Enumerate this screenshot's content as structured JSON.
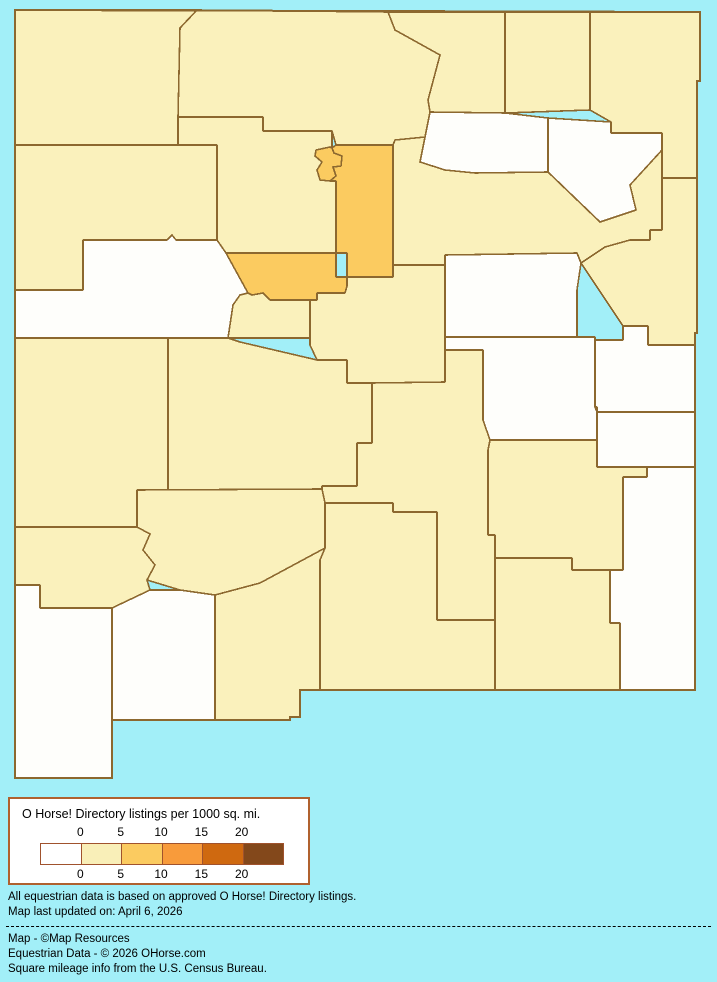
{
  "page": {
    "background": "#A2EFF8"
  },
  "map": {
    "border_color": "#8C682F",
    "outline_color": "#8C682F",
    "fills": {
      "zero": "#FEFEFB",
      "low": "#FAF1BC",
      "mid": "#FBCB60"
    },
    "outline_d": "M15,10 L700,12 L700,81 L697,81 L697,333 L695,333 L695,690 L300,690 L300,717 L290,717 L290,720 L112,720 L112,778 L15,778 Z",
    "regions": [
      {
        "name": "san-juan",
        "level": "low",
        "d": "M15,10 L197,10 L180,28 L178,117 L178,145 L15,145 Z"
      },
      {
        "name": "rio-arriba",
        "level": "low",
        "d": "M197,10 L388,12 L395,30 L440,55 L428,100 L430,112 L425,137 L395,140 L393,145 L336,145 L332,131 L263,131 L263,117 L178,117 L180,28 Z"
      },
      {
        "name": "taos",
        "level": "low",
        "d": "M388,12 L505,12 L505,113 L430,112 L428,100 L440,55 L395,30 Z"
      },
      {
        "name": "colfax",
        "level": "low",
        "d": "M505,12 L590,12 L590,110 L505,113 Z"
      },
      {
        "name": "union",
        "level": "low",
        "d": "M590,12 L700,12 L700,81 L697,81 L697,178 L662,178 L662,133 L611,133 L611,122 L590,110 Z"
      },
      {
        "name": "mckinley",
        "level": "low",
        "d": "M15,145 L217,145 L217,240 L176,240 L172,235 L167,240 L83,240 L83,290 L15,290 Z"
      },
      {
        "name": "sandoval",
        "level": "low",
        "d": "M178,117 L263,117 L263,131 L332,131 L332,148 L330,147 L316,150 L315,156 L322,162 L317,170 L320,180 L330,181 L336,181 L336,253 L226,253 L217,240 L217,145 L178,145 Z"
      },
      {
        "name": "los-alamos",
        "level": "mid",
        "d": "M316,150 L330,147 L332,148 L334,153 L342,156 L341,166 L333,167 L336,176 L330,181 L320,180 L317,170 L322,162 L315,156 Z"
      },
      {
        "name": "santa-fe",
        "level": "mid",
        "d": "M336,145 L393,145 L393,277 L347,277 L347,253 L336,253 L336,181 L330,181 L336,176 L333,167 L341,166 L342,156 L334,153 L332,148 Z"
      },
      {
        "name": "mora",
        "level": "zero",
        "d": "M430,112 L505,113 L548,118 L548,172 L475,173 L445,170 L420,162 L425,137 Z"
      },
      {
        "name": "harding",
        "level": "zero",
        "d": "M548,118 L611,122 L611,133 L662,133 L662,150 L630,185 L636,210 L600,222 L548,172 Z"
      },
      {
        "name": "san-miguel",
        "level": "low",
        "d": "M393,145 L395,140 L425,137 L420,162 L445,170 L475,173 L548,172 L600,222 L636,210 L630,185 L662,150 L662,230 L650,230 L650,240 L630,240 L605,247 L581,263 L577,253 L445,255 L445,265 L393,265 Z"
      },
      {
        "name": "quay",
        "level": "low",
        "d": "M662,178 L697,178 L697,333 L695,333 L695,345 L648,345 L648,326 L623,326 L581,263 L605,247 L630,240 L650,240 L650,230 L662,230 Z"
      },
      {
        "name": "cibola",
        "level": "zero",
        "d": "M83,240 L167,240 L172,235 L176,240 L217,240 L226,253 L248,293 L240,295 L233,305 L228,338 L15,338 L15,290 L83,290 Z"
      },
      {
        "name": "bernalillo",
        "level": "mid",
        "d": "M226,253 L336,253 L336,277 L347,277 L347,286 L345,293 L317,293 L317,300 L270,300 L263,293 L252,295 L248,293 Z"
      },
      {
        "name": "valencia",
        "level": "low",
        "d": "M248,293 L252,295 L263,293 L270,300 L310,300 L310,338 L228,338 L233,305 L240,295 Z"
      },
      {
        "name": "torrance",
        "level": "low",
        "d": "M317,293 L345,293 L347,286 L347,277 L393,277 L393,265 L445,265 L445,382 L372,383 L347,383 L347,360 L317,360 L310,345 L310,300 L317,300 Z"
      },
      {
        "name": "guadalupe",
        "level": "zero",
        "d": "M445,255 L577,253 L581,263 L577,290 L577,337 L445,337 Z"
      },
      {
        "name": "de-baca",
        "level": "zero",
        "d": "M445,337 L595,337 L595,407 L597,412 L597,440 L490,440 L483,420 L483,350 L445,350 Z"
      },
      {
        "name": "curry",
        "level": "zero",
        "d": "M623,326 L648,326 L648,345 L695,345 L695,412 L597,412 L597,407 L595,407 L595,340 L623,340 Z"
      },
      {
        "name": "roosevelt",
        "level": "zero",
        "d": "M597,412 L695,412 L695,467 L647,467 L647,477 L623,477 L623,467 L597,467 Z"
      },
      {
        "name": "catron",
        "level": "low",
        "d": "M15,338 L168,338 L168,490 L137,490 L137,527 L15,527 Z"
      },
      {
        "name": "socorro",
        "level": "low",
        "d": "M168,338 L228,338 L240,342 L317,360 L347,360 L347,383 L372,383 L372,443 L357,443 L357,486 L322,486 L322,489 L168,490 Z"
      },
      {
        "name": "lincoln",
        "level": "low",
        "d": "M372,383 L445,382 L445,350 L483,350 L483,420 L490,440 L488,450 L488,535 L495,535 L495,558 L495,620 L437,620 L437,512 L393,512 L393,503 L325,503 L322,489 L322,486 L357,486 L357,443 L372,443 Z"
      },
      {
        "name": "chaves",
        "level": "low",
        "d": "M490,440 L597,440 L597,467 L623,467 L647,467 L647,477 L623,477 L623,570 L610,570 L572,570 L572,558 L495,558 L495,535 L488,535 L488,450 Z"
      },
      {
        "name": "lea",
        "level": "zero",
        "d": "M623,477 L647,477 L647,467 L695,467 L695,690 L620,690 L620,623 L610,623 L610,570 L623,570 Z"
      },
      {
        "name": "sierra",
        "level": "low",
        "d": "M137,490 L322,489 L325,503 L325,548 L260,583 L215,595 L180,590 L147,580 L155,565 L143,550 L150,534 L137,527 Z"
      },
      {
        "name": "grant",
        "level": "low",
        "d": "M15,527 L137,527 L150,534 L143,550 L155,565 L147,580 L150,590 L130,600 L112,608 L40,608 L40,585 L15,585 Z"
      },
      {
        "name": "hidalgo",
        "level": "zero",
        "d": "M15,585 L40,585 L40,608 L112,608 L112,778 L15,778 Z"
      },
      {
        "name": "luna",
        "level": "zero",
        "d": "M112,608 L150,590 L180,590 L215,595 L215,720 L112,720 Z"
      },
      {
        "name": "dona-ana",
        "level": "low",
        "d": "M215,595 L260,583 L325,548 L320,560 L320,690 L300,690 L300,717 L290,717 L290,720 L215,720 Z"
      },
      {
        "name": "otero",
        "level": "low",
        "d": "M325,503 L393,503 L393,512 L437,512 L437,620 L495,620 L495,690 L320,690 L320,560 L325,548 Z"
      },
      {
        "name": "eddy",
        "level": "low",
        "d": "M495,558 L572,558 L572,570 L610,570 L610,623 L620,623 L620,690 L495,690 Z"
      }
    ]
  },
  "legend": {
    "title": "O Horse! Directory listings per 1000 sq. mi.",
    "ticks": [
      "0",
      "5",
      "10",
      "15",
      "20"
    ],
    "colors": [
      "#FFFFFF",
      "#F9EFB8",
      "#FBCB60",
      "#F89B3B",
      "#CF6910",
      "#83481B"
    ],
    "border_color": "#B0612F"
  },
  "notes": {
    "line1": "All equestrian data is based on approved O Horse! Directory listings.",
    "line2": "Map last updated on: April 6, 2026"
  },
  "credits": {
    "line1": "Map - ©Map Resources",
    "line2": "Equestrian Data - © 2026 OHorse.com",
    "line3": "Square mileage info from the U.S. Census Bureau."
  }
}
